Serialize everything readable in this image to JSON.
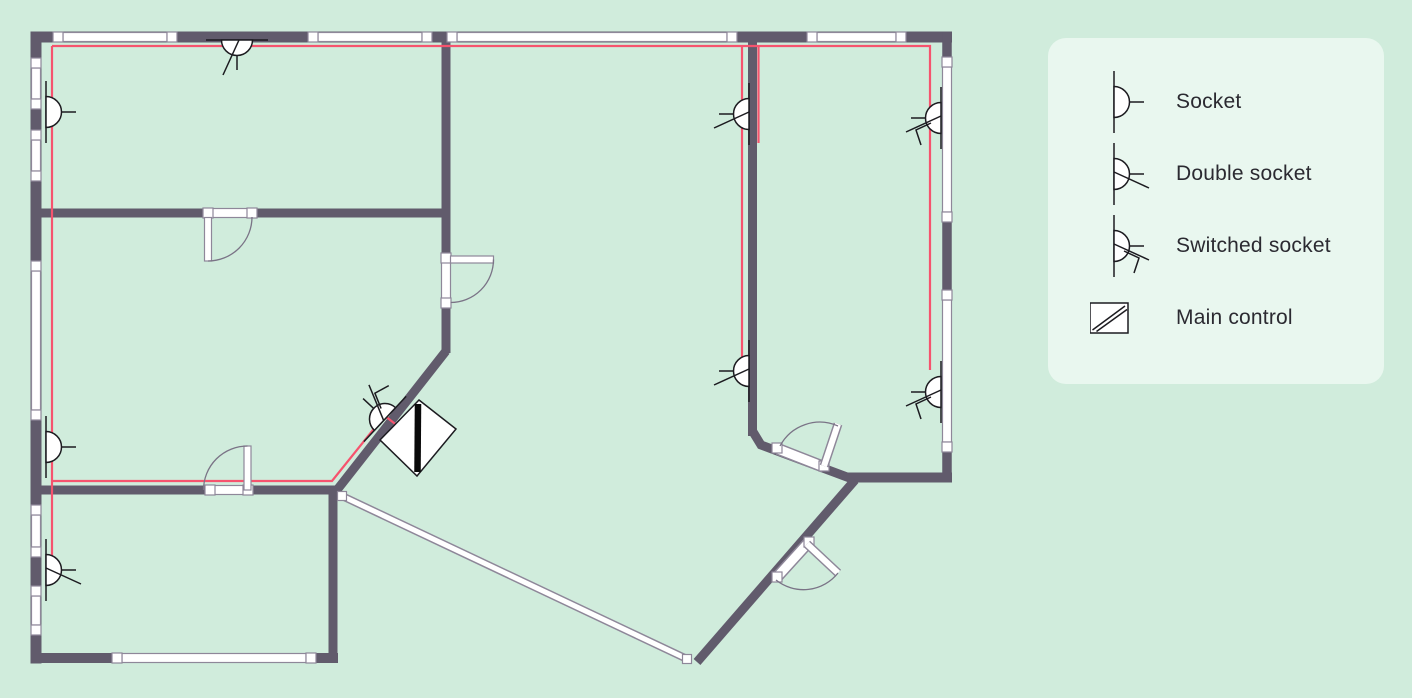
{
  "colors": {
    "background": "#d0ecdc",
    "panel": "#e9f7ef",
    "wall": "#615b6c",
    "window_stroke": "#8e8799",
    "wire": "#f6536e",
    "symbol_stroke": "#1c1b20",
    "door_arc": "#7a7386",
    "text": "#2b2a31"
  },
  "legend": {
    "items": [
      {
        "id": "socket",
        "symbol": "#sym-socket",
        "label": "Socket"
      },
      {
        "id": "double",
        "symbol": "#sym-double",
        "label": "Double socket"
      },
      {
        "id": "switched",
        "symbol": "#sym-switched",
        "label": "Switched socket"
      },
      {
        "id": "maincontrol",
        "symbol": "#sym-maincontrol",
        "label": "Main control"
      }
    ]
  },
  "plan": {
    "wires": [
      {
        "name": "wire-top-and-right-drop",
        "points": [
          [
            52,
            46
          ],
          [
            930,
            46
          ],
          [
            930,
            370
          ]
        ]
      },
      {
        "name": "wire-left-drop",
        "points": [
          [
            52,
            46
          ],
          [
            52,
            556
          ]
        ]
      },
      {
        "name": "wire-bottom-branch",
        "points": [
          [
            52,
            481
          ],
          [
            332,
            481
          ],
          [
            385,
            415
          ]
        ]
      },
      {
        "name": "wire-middle-drop",
        "points": [
          [
            742,
            46
          ],
          [
            742,
            363
          ]
        ]
      },
      {
        "name": "wire-middle-short-drop",
        "points": [
          [
            758.5,
            46
          ],
          [
            758.5,
            143
          ]
        ]
      },
      {
        "name": "wire-main-control-stub",
        "points": [
          [
            385,
            416
          ],
          [
            403,
            430
          ]
        ]
      }
    ],
    "windows": [
      {
        "wall": "top",
        "axis": "h",
        "c": 37,
        "from": 58,
        "to": 172
      },
      {
        "wall": "top",
        "axis": "h",
        "c": 37,
        "from": 313,
        "to": 427
      },
      {
        "wall": "top",
        "axis": "h",
        "c": 37,
        "from": 452,
        "to": 732
      },
      {
        "wall": "top",
        "axis": "h",
        "c": 37,
        "from": 812,
        "to": 901
      },
      {
        "wall": "left",
        "axis": "v",
        "c": 36,
        "from": 63,
        "to": 104
      },
      {
        "wall": "left",
        "axis": "v",
        "c": 36,
        "from": 135,
        "to": 176
      },
      {
        "wall": "left",
        "axis": "v",
        "c": 36,
        "from": 266,
        "to": 415
      },
      {
        "wall": "left",
        "axis": "v",
        "c": 36,
        "from": 510,
        "to": 552
      },
      {
        "wall": "left",
        "axis": "v",
        "c": 36,
        "from": 591,
        "to": 630
      },
      {
        "wall": "bottom",
        "axis": "h",
        "c": 658,
        "from": 117,
        "to": 311
      },
      {
        "wall": "right",
        "axis": "v",
        "c": 947,
        "from": 62,
        "to": 217
      },
      {
        "wall": "right",
        "axis": "v",
        "c": 947,
        "from": 295,
        "to": 447
      }
    ],
    "sockets": [
      {
        "type": "socket",
        "x": 46,
        "y": 112,
        "rot": 0,
        "flip": false
      },
      {
        "type": "socket",
        "x": 46,
        "y": 447,
        "rot": 0,
        "flip": false
      },
      {
        "type": "double",
        "x": 46,
        "y": 570,
        "rot": 0,
        "flip": false
      },
      {
        "type": "double",
        "x": 237,
        "y": 40,
        "rot": 90,
        "flip": false
      },
      {
        "type": "double",
        "x": 749,
        "y": 114,
        "rot": 180,
        "flip": true
      },
      {
        "type": "double",
        "x": 749,
        "y": 371,
        "rot": 180,
        "flip": true
      },
      {
        "type": "switched",
        "x": 941,
        "y": 118,
        "rot": 180,
        "flip": true
      },
      {
        "type": "switched",
        "x": 941,
        "y": 392,
        "rot": 180,
        "flip": true
      },
      {
        "type": "switched",
        "x": 385,
        "y": 419,
        "rot": 223,
        "flip": false
      }
    ],
    "main_control": {
      "present": true,
      "x": 418,
      "y": 438
    }
  }
}
